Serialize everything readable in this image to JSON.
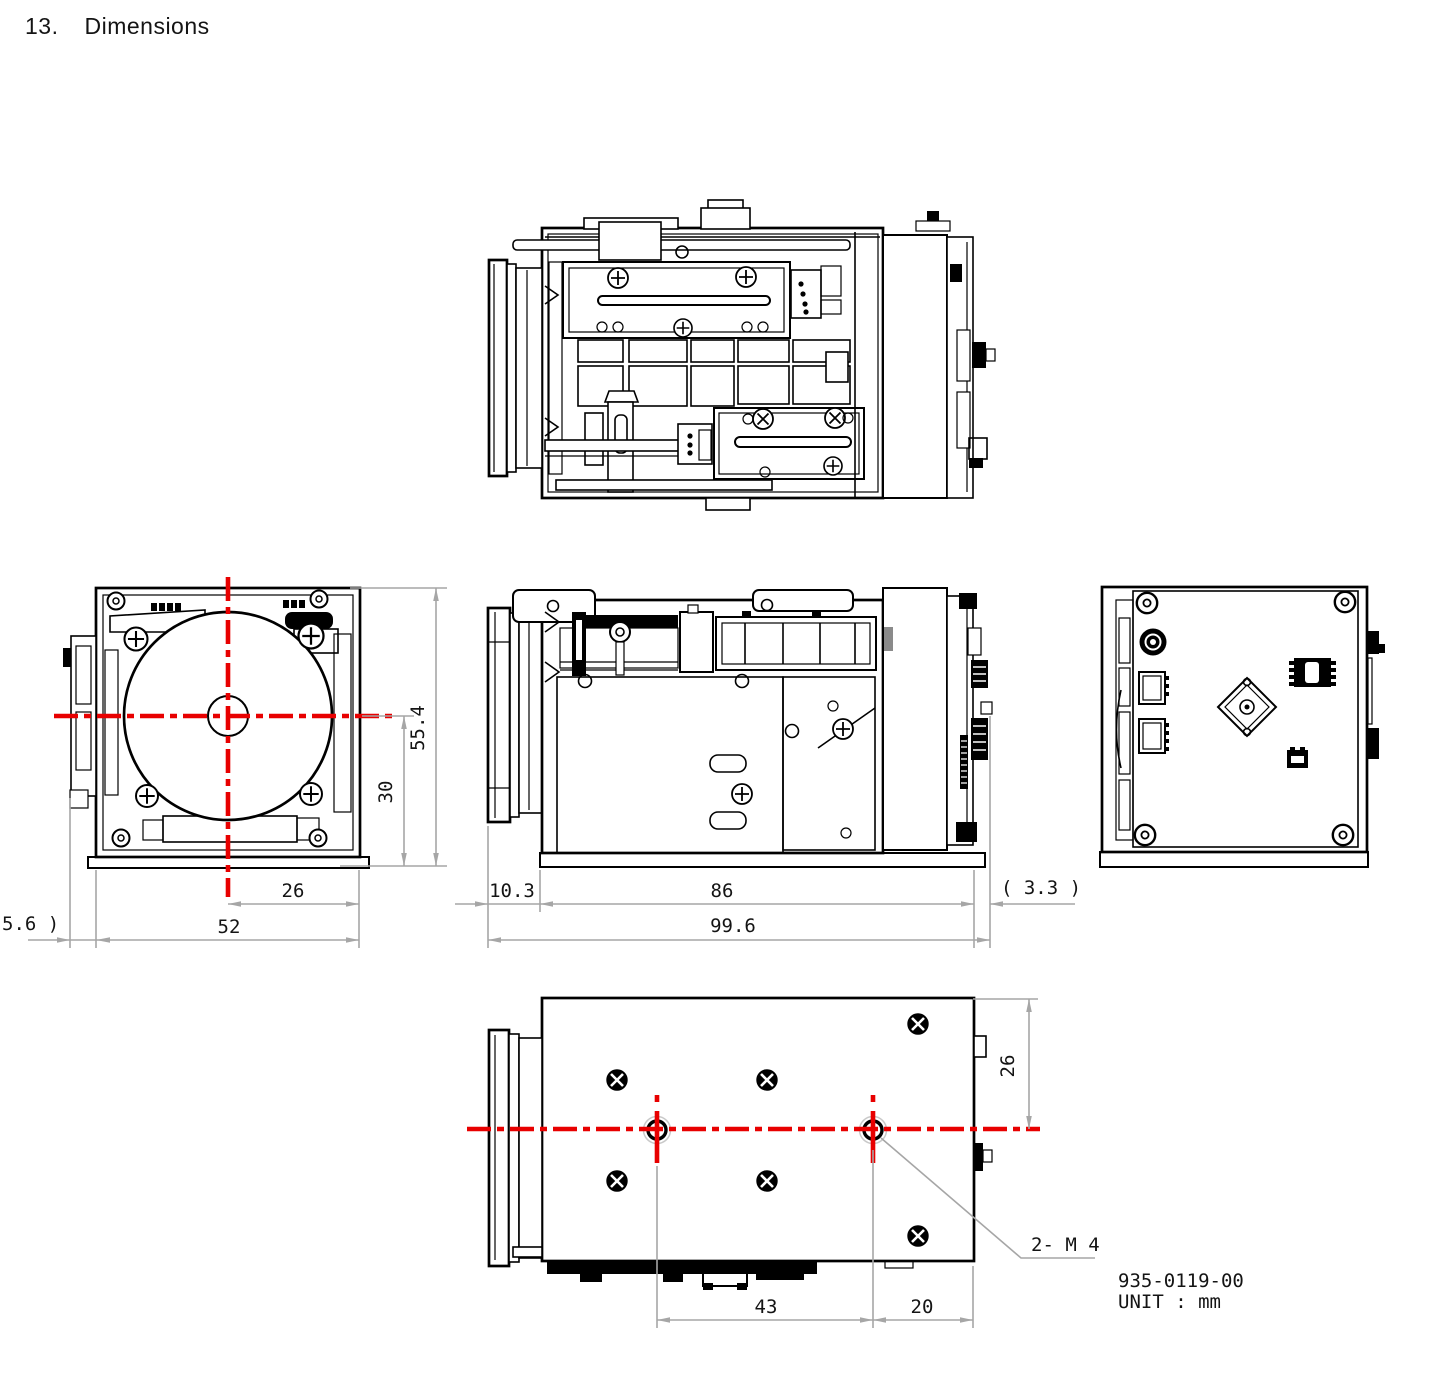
{
  "page": {
    "section_number": "13.",
    "section_title": "Dimensions"
  },
  "title_block": {
    "part_number": "935-0119-00",
    "unit_note": "UNIT : mm"
  },
  "colors": {
    "line": "#000000",
    "dim": "#a6a6a6",
    "centerline": "#e80000",
    "text": "#141414",
    "paper": "#ffffff"
  },
  "views": {
    "front": {
      "dims": {
        "center_to_right": "26",
        "overall_width": "52",
        "left_protrusion": "5.6 )",
        "center_to_bottom": "30",
        "overall_height": "55.4"
      }
    },
    "side": {
      "dims": {
        "lens_front": "10.3",
        "body_length": "86",
        "rear_protrusion": "( 3.3 )",
        "overall_length": "99.6"
      }
    },
    "bottom": {
      "dims": {
        "mount_hole_spacing": "43",
        "hole_to_rear": "20",
        "rear_to_center": "26"
      },
      "thread_callout": "2- M 4"
    }
  }
}
